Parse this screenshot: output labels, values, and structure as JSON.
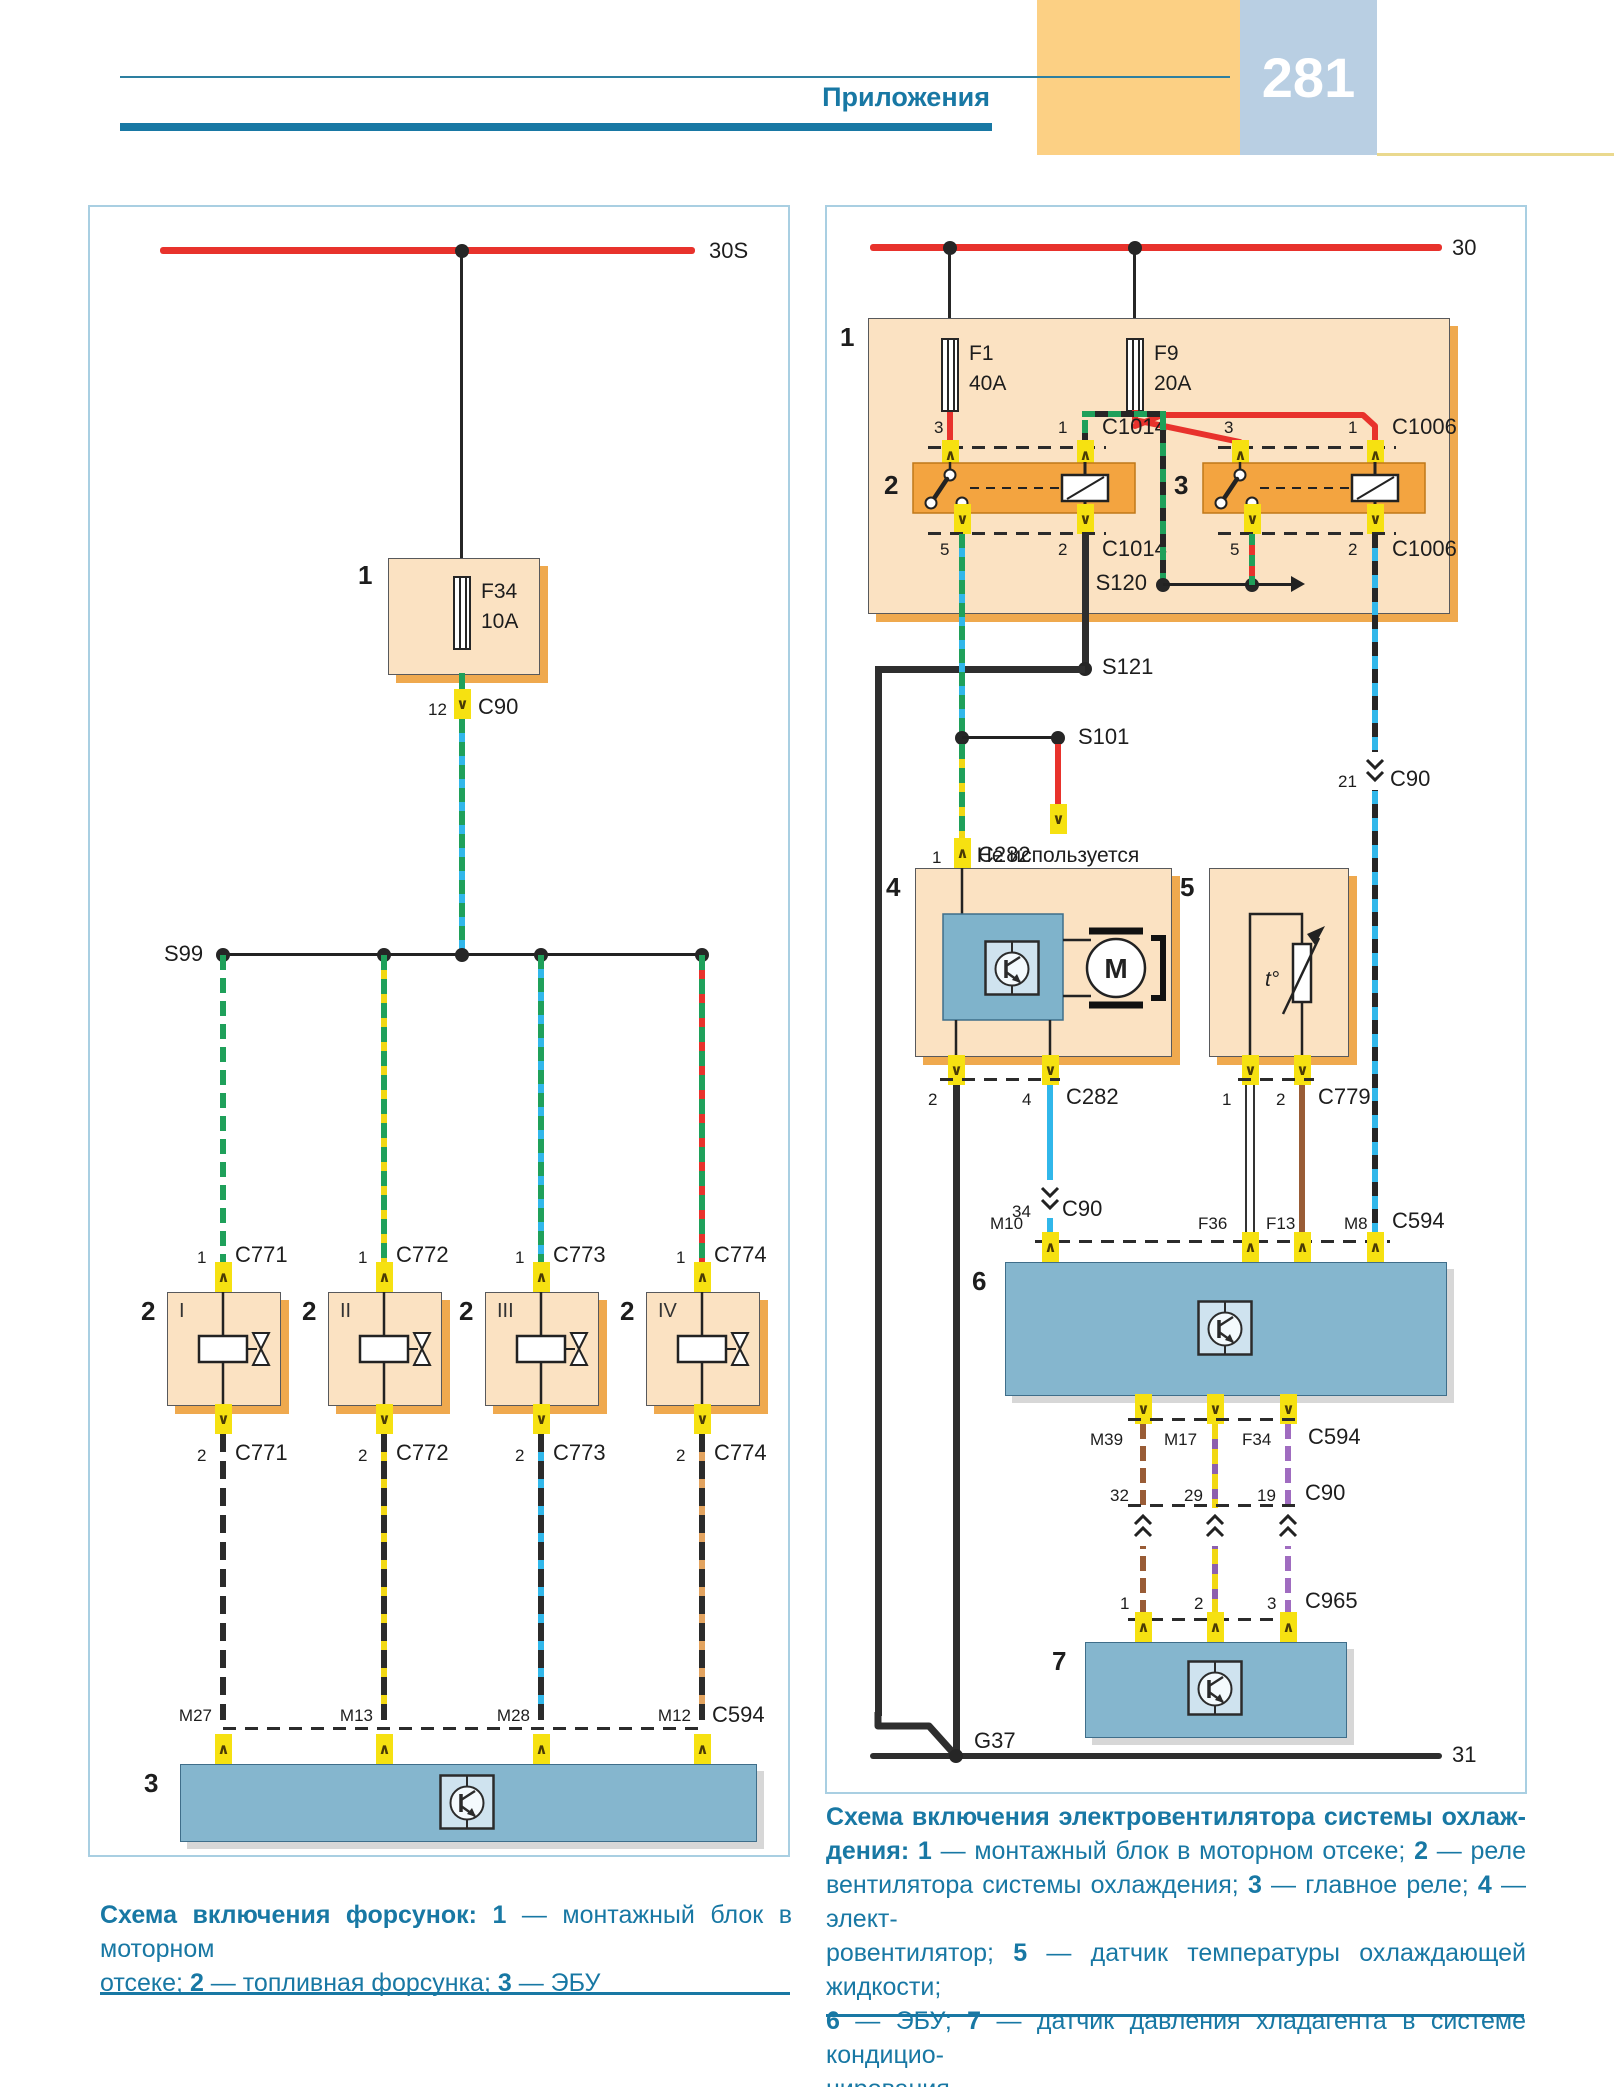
{
  "icons": {
    "chevron_up": "∧",
    "chevron_down": "∨"
  },
  "colors": {
    "accent_teal": "#1878a4",
    "bus_red": "#e8322c",
    "block_blue": "#85b6ce",
    "box_peach": "#fbe2c2",
    "relay_orange": "#f3a440",
    "connector_yellow": "#f6e111",
    "band_orange": "#fcd084",
    "band_blue": "#b9cfe3"
  },
  "header": {
    "title": "Приложения",
    "page": "281"
  },
  "left": {
    "bus_label": "30S",
    "block1": {
      "num": "1",
      "fuse_name": "F34",
      "fuse_amps": "10A"
    },
    "c90": {
      "pin": "12",
      "label": "C90"
    },
    "splice": "S99",
    "branches": [
      {
        "pin_top": "1",
        "conn_top": "C771",
        "num": "2",
        "roman": "I",
        "pin_bot": "2",
        "conn_bot": "C771",
        "ecu_pin": "M27"
      },
      {
        "pin_top": "1",
        "conn_top": "C772",
        "num": "2",
        "roman": "II",
        "pin_bot": "2",
        "conn_bot": "C772",
        "ecu_pin": "M13"
      },
      {
        "pin_top": "1",
        "conn_top": "C773",
        "num": "2",
        "roman": "III",
        "pin_bot": "2",
        "conn_bot": "C773",
        "ecu_pin": "M28"
      },
      {
        "pin_top": "1",
        "conn_top": "C774",
        "num": "2",
        "roman": "IV",
        "pin_bot": "2",
        "conn_bot": "C774",
        "ecu_pin": "M12"
      }
    ],
    "ecu": {
      "num": "3",
      "conn": "C594"
    },
    "caption": [
      {
        "j": 1,
        "r": [
          {
            "t": "Схема включения форсунок: ",
            "b": 1
          },
          {
            "t": "1",
            "b": 1
          },
          {
            "t": " — монтажный блок в моторном",
            "b": 0
          }
        ]
      },
      {
        "j": 0,
        "r": [
          {
            "t": "отсеке; ",
            "b": 0
          },
          {
            "t": "2",
            "b": 1
          },
          {
            "t": " — топливная форсунка; ",
            "b": 0
          },
          {
            "t": "3",
            "b": 1
          },
          {
            "t": " — ЭБУ",
            "b": 0
          }
        ]
      }
    ]
  },
  "right": {
    "bus_top": "30",
    "bus_bottom": "31",
    "ground": "G37",
    "block1": {
      "num": "1",
      "f1": "F1",
      "f1_amps": "40A",
      "f9": "F9",
      "f9_amps": "20A"
    },
    "relay2": {
      "num": "2",
      "p3": "3",
      "p1": "1",
      "p5": "5",
      "p2": "2",
      "conn": "C1014"
    },
    "relay3": {
      "num": "3",
      "p3": "3",
      "p1": "1",
      "p5": "5",
      "p2": "2",
      "conn": "C1006"
    },
    "s120": "S120",
    "s121": "S121",
    "s101": "S101",
    "not_used": "Не используется",
    "c90_21": {
      "pin": "21",
      "label": "C90"
    },
    "c282_top": {
      "pin": "1",
      "label": "C282"
    },
    "fan": {
      "num": "4",
      "motor": "M"
    },
    "fan_pins": {
      "p2": "2",
      "p4": "4",
      "conn": "C282"
    },
    "sensor": {
      "num": "5",
      "t": "t°"
    },
    "sensor_pins": {
      "p1": "1",
      "p2": "2",
      "conn": "C779"
    },
    "c90_34": {
      "pin": "34",
      "label": "C90"
    },
    "ecu": {
      "num": "6"
    },
    "ecu_top": {
      "m10": "M10",
      "f36": "F36",
      "f13": "F13",
      "m8": "M8",
      "conn": "C594"
    },
    "ecu_bot": {
      "m39": "M39",
      "m17": "M17",
      "f34": "F34",
      "conn": "C594"
    },
    "c90_cross": {
      "p1": "32",
      "p2": "29",
      "p3": "19",
      "label": "C90"
    },
    "c965": {
      "p1": "1",
      "p2": "2",
      "p3": "3",
      "label": "C965"
    },
    "block7": {
      "num": "7"
    },
    "caption": [
      {
        "j": 1,
        "r": [
          {
            "t": "Схема включения электровентилятора системы охлаж-",
            "b": 1
          }
        ]
      },
      {
        "j": 1,
        "r": [
          {
            "t": "дения: ",
            "b": 1
          },
          {
            "t": "1",
            "b": 1
          },
          {
            "t": " — монтажный блок в моторном отсеке; ",
            "b": 0
          },
          {
            "t": "2",
            "b": 1
          },
          {
            "t": " — реле",
            "b": 0
          }
        ]
      },
      {
        "j": 1,
        "r": [
          {
            "t": "вентилятора системы охлаждения; ",
            "b": 0
          },
          {
            "t": "3",
            "b": 1
          },
          {
            "t": " — главное реле; ",
            "b": 0
          },
          {
            "t": "4",
            "b": 1
          },
          {
            "t": " — элект-",
            "b": 0
          }
        ]
      },
      {
        "j": 1,
        "r": [
          {
            "t": "ровентилятор; ",
            "b": 0
          },
          {
            "t": "5",
            "b": 1
          },
          {
            "t": " — датчик температуры охлаждающей жидкости;",
            "b": 0
          }
        ]
      },
      {
        "j": 1,
        "r": [
          {
            "t": "6",
            "b": 1
          },
          {
            "t": " — ЭБУ; ",
            "b": 0
          },
          {
            "t": "7",
            "b": 1
          },
          {
            "t": " — датчик давления хладагента в системе кондицио-",
            "b": 0
          }
        ]
      },
      {
        "j": 0,
        "r": [
          {
            "t": "нирования",
            "b": 0
          }
        ]
      }
    ]
  }
}
